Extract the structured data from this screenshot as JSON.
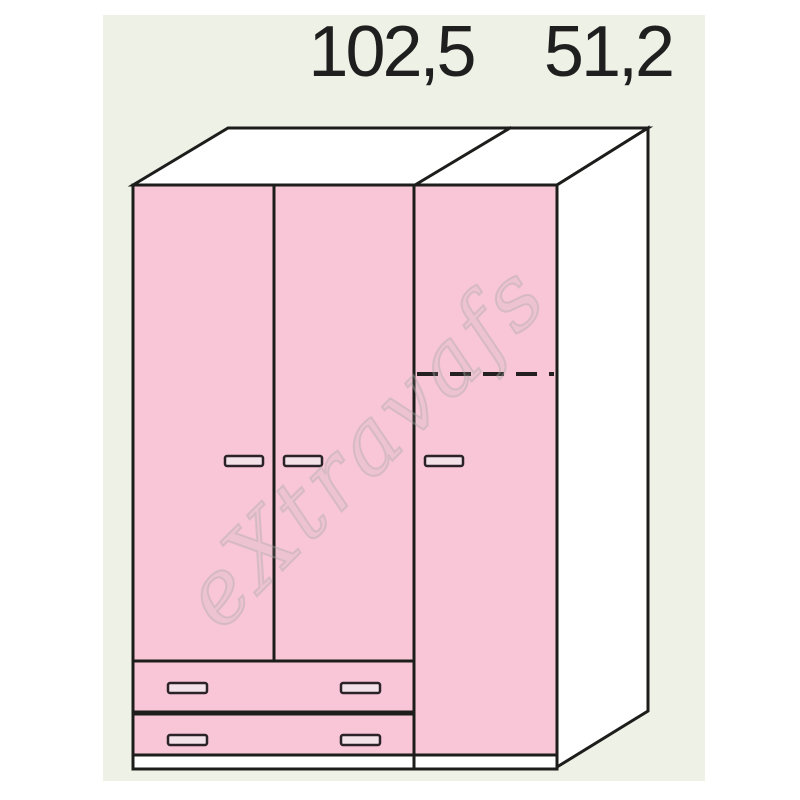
{
  "diagram": {
    "dimension_labels": {
      "left_module_width": "102,5",
      "right_module_width": "51,2"
    },
    "watermark_text": "eXtravafs",
    "colors": {
      "page_background": "#ffffff",
      "panel_background": "#eef1e6",
      "outline": "#1d1d1b",
      "door_pink": "#f8c6d7",
      "handle_fill": "#f2e3e9",
      "face_white": "#ffffff",
      "dimension_text": "#1f1f1f"
    },
    "wardrobe": {
      "left_module": {
        "doors": 2,
        "drawers": 2,
        "width_label": "102,5"
      },
      "right_module": {
        "doors": 1,
        "width_label": "51,2",
        "has_dashed_line": true
      }
    }
  }
}
